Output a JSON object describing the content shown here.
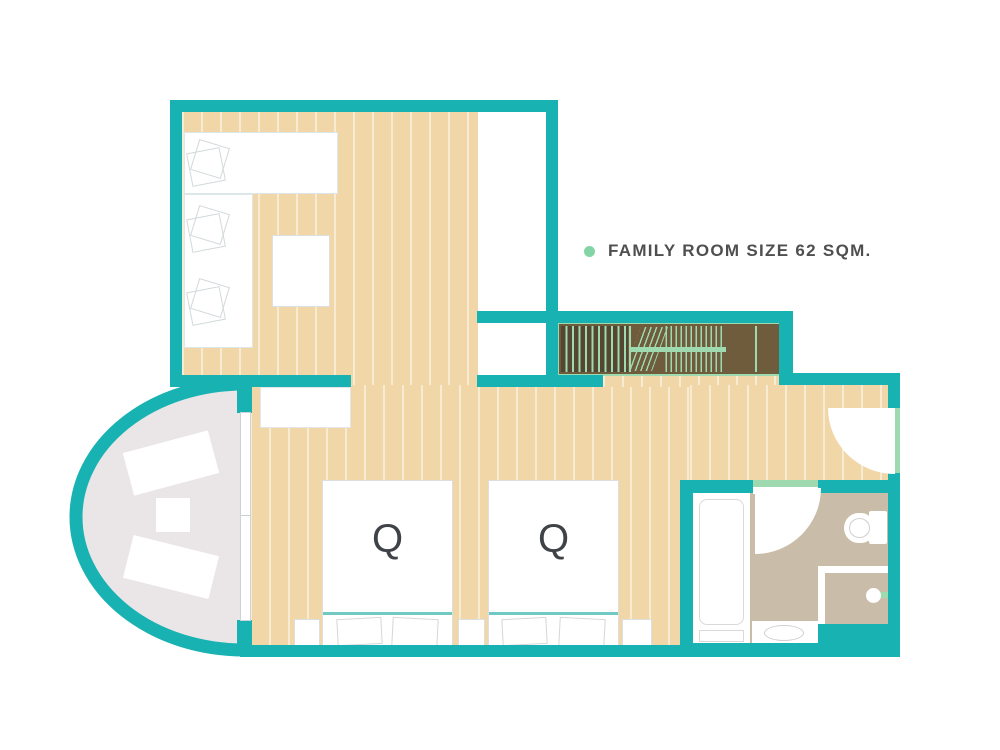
{
  "legend": {
    "label": "FAMILY ROOM SIZE 62 SQM."
  },
  "beds": [
    {
      "label": "Q"
    },
    {
      "label": "Q"
    }
  ],
  "colors": {
    "teal": "#19b2b2",
    "tan": "#f1d7a7",
    "mint": "#9ed9af",
    "brown": "#6f5c3d",
    "brown-dark": "#544631",
    "taupe": "#c9bca8",
    "balcony": "#eae6e8",
    "bullet": "#84d5a5",
    "ink": "#4f4f4f"
  },
  "rooms": {
    "living": "living-room",
    "bedroom": "bedroom",
    "bathroom": "bathroom",
    "balcony": "balcony",
    "wardrobe": "wardrobe-closet"
  }
}
